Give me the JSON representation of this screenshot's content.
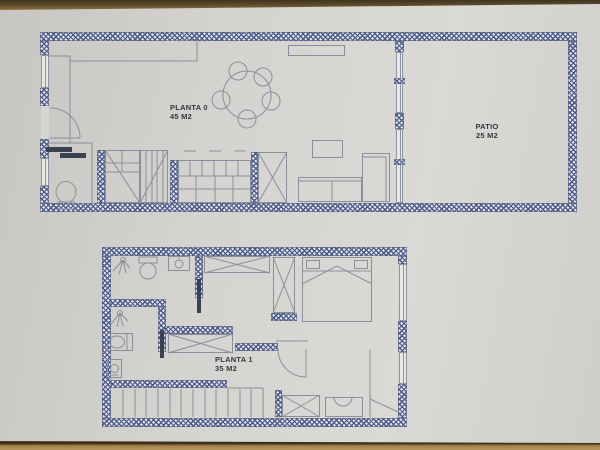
{
  "plans": {
    "planta0": {
      "label": "PLANTA 0",
      "area": "45 M2"
    },
    "patio": {
      "label": "PATIO",
      "area": "25 M2"
    },
    "planta1": {
      "label": "PLANTA 1",
      "area": "35 M2"
    }
  },
  "colors": {
    "paper": "#d6d5d2",
    "wood_table": "#a2824c",
    "wall_hatch": "#4b5a8c",
    "linework": "#8a8f9b",
    "label_text": "#34373d",
    "pocket_door": "#3a4150"
  }
}
